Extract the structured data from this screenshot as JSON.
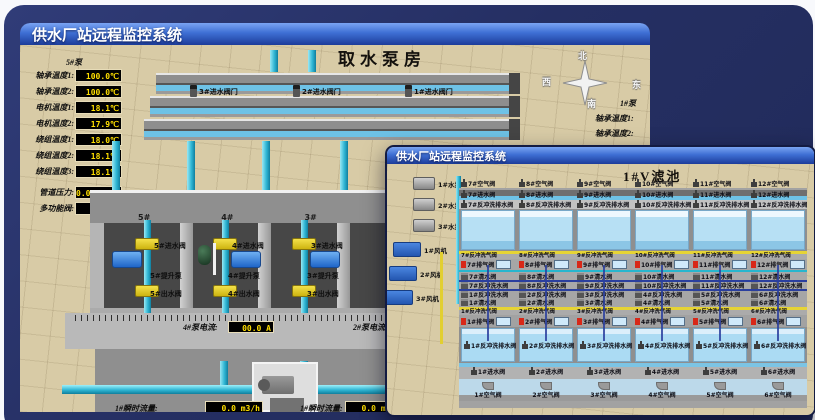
{
  "colors": {
    "led_text": "#ffdf00",
    "titlebar_blue": "#3e6fd4",
    "pipe_teal": "#2fb6d4",
    "valve_yellow": "#e6d435",
    "alarm_red": "#d82818",
    "pool_blue": "#abdbf3",
    "backdrop_navy": "#252f63"
  },
  "back_window": {
    "titlebar": "供水厂站远程监控系统",
    "heading": "取水泵房",
    "pump_group_label": "5#泵",
    "readouts": [
      {
        "label": "轴承温度1:",
        "value": "100.0℃"
      },
      {
        "label": "轴承温度2:",
        "value": "100.0℃"
      },
      {
        "label": "电机温度1:",
        "value": "18.1℃"
      },
      {
        "label": "电机温度2:",
        "value": "17.9℃"
      },
      {
        "label": "绕组温度1:",
        "value": "18.0℃"
      },
      {
        "label": "绕组温度2:",
        "value": "18.1℃"
      },
      {
        "label": "绕组温度3:",
        "value": "18.1℃"
      },
      {
        "label": "管道压力:",
        "value": "0.0007MPa"
      },
      {
        "label": "多功能阀:",
        "value": "0%"
      }
    ],
    "channel_valves": [
      "3#进水阀门",
      "2#进水阀门",
      "1#进水阀门"
    ],
    "compass": {
      "north": "北",
      "west": "西",
      "south": "南",
      "east": "东"
    },
    "right_group_label": "1#泵",
    "right_readouts": [
      "轴承温度1:",
      "轴承温度2:"
    ],
    "pump_bays": [
      "5#",
      "4#",
      "3#",
      "2#"
    ],
    "assemblies": [
      {
        "inlet": "5#进水阀",
        "pump": "5#提升泵",
        "outlet": "5#出水阀"
      },
      {
        "inlet": "4#进水阀",
        "pump": "4#提升泵",
        "outlet": "4#出水阀"
      },
      {
        "inlet": "3#进水阀",
        "pump": "3#提升泵",
        "outlet": "3#出水阀"
      }
    ],
    "current_readout": {
      "label": "4#泵电流:",
      "value": "00.0 A"
    },
    "current_readout_2_label": "2#泵电流",
    "flow_readouts": [
      {
        "label": "1#瞬时流量:",
        "value": "0.0 m3/h"
      },
      {
        "label": "1#瞬时流量:",
        "value": "0.0 m3/h"
      }
    ]
  },
  "front_window": {
    "titlebar": "供水厂站远程监控系统",
    "heading": "1#V滤池",
    "left_pumps": [
      "1#水泵",
      "2#水泵",
      "3#水泵"
    ],
    "left_fans": [
      "1#风机",
      "2#风机",
      "3#风机"
    ],
    "top_bank": {
      "air": [
        "7#空气阀",
        "8#空气阀",
        "9#空气阀",
        "10#空气阀",
        "11#空气阀",
        "12#空气阀"
      ],
      "inlet": [
        "7#进水阀",
        "8#进水阀",
        "9#进水阀",
        "10#进水阀",
        "11#进水阀",
        "12#进水阀"
      ],
      "backwash_drain": [
        "7#反冲洗排水阀",
        "8#反冲洗排水阀",
        "9#反冲洗排水阀",
        "10#反冲洗排水阀",
        "11#反冲洗排水阀",
        "12#反冲洗排水阀"
      ],
      "backwash_air": [
        "7#反冲洗气阀",
        "8#反冲洗气阀",
        "9#反冲洗气阀",
        "10#反冲洗气阀",
        "11#反冲洗气阀",
        "12#反冲洗气阀"
      ],
      "exhaust": [
        "7#排气阀",
        "8#排气阀",
        "9#排气阀",
        "10#排气阀",
        "11#排气阀",
        "12#排气阀"
      ],
      "clean": [
        "7#清水阀",
        "8#清水阀",
        "9#清水阀",
        "10#清水阀",
        "11#清水阀",
        "12#清水阀"
      ],
      "backwash_water": [
        "7#反冲洗水阀",
        "8#反冲洗水阀",
        "9#反冲洗水阀",
        "10#反冲洗水阀",
        "11#反冲洗水阀",
        "12#反冲洗水阀"
      ]
    },
    "bottom_bank": {
      "backwash_water": [
        "1#反冲洗水阀",
        "2#反冲洗水阀",
        "3#反冲洗水阀",
        "4#反冲洗水阀",
        "5#反冲洗水阀",
        "6#反冲洗水阀"
      ],
      "clean": [
        "1#清水阀",
        "2#清水阀",
        "3#清水阀",
        "4#清水阀",
        "5#清水阀",
        "6#清水阀"
      ],
      "backwash_air": [
        "1#反冲洗气阀",
        "2#反冲洗气阀",
        "3#反冲洗气阀",
        "4#反冲洗气阀",
        "5#反冲洗气阀",
        "6#反冲洗气阀"
      ],
      "exhaust": [
        "1#排气阀",
        "2#排气阀",
        "3#排气阀",
        "4#排气阀",
        "5#排气阀",
        "6#排气阀"
      ],
      "backwash_drain": [
        "1#反冲洗排水阀",
        "2#反冲洗排水阀",
        "3#反冲洗排水阀",
        "4#反冲洗排水阀",
        "5#反冲洗排水阀",
        "6#反冲洗排水阀"
      ],
      "inlet": [
        "1#进水阀",
        "2#进水阀",
        "3#进水阀",
        "4#进水阀",
        "5#进水阀",
        "6#进水阀"
      ],
      "air": [
        "1#空气阀",
        "2#空气阀",
        "3#空气阀",
        "4#空气阀",
        "5#空气阀",
        "6#空气阀"
      ]
    }
  }
}
